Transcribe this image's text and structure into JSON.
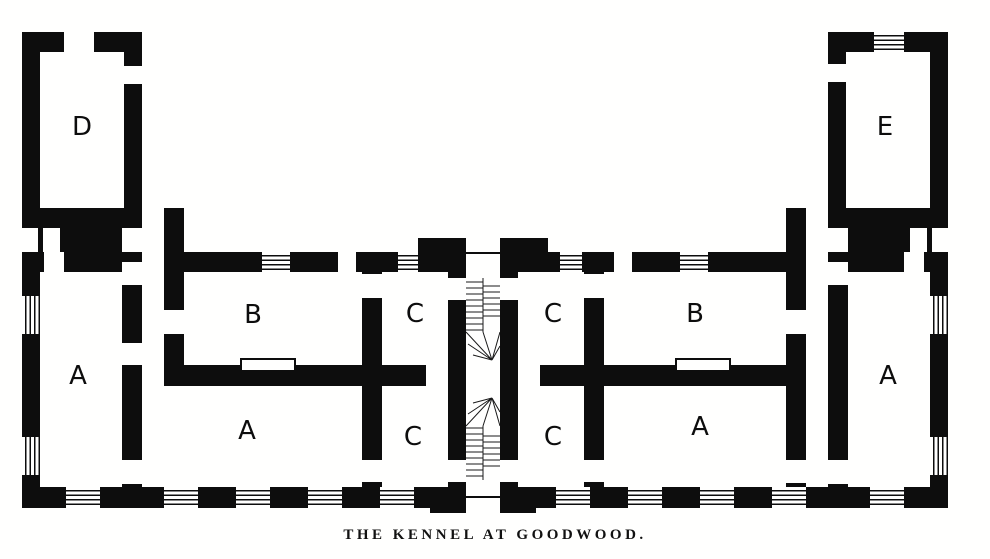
{
  "figure": {
    "type": "architectural-floor-plan-engraving",
    "caption": "THE KENNEL AT GOODWOOD.",
    "rooms": [
      {
        "key": "room-d",
        "label": "D"
      },
      {
        "key": "room-e",
        "label": "E"
      },
      {
        "key": "room-a-west-end",
        "label": "A"
      },
      {
        "key": "room-b-west",
        "label": "B"
      },
      {
        "key": "room-c-upper-west",
        "label": "C"
      },
      {
        "key": "room-c-upper-east",
        "label": "C"
      },
      {
        "key": "room-b-east",
        "label": "B"
      },
      {
        "key": "room-a-east-end",
        "label": "A"
      },
      {
        "key": "room-a-lower-west",
        "label": "A"
      },
      {
        "key": "room-c-lower-west",
        "label": "C"
      },
      {
        "key": "room-c-lower-east",
        "label": "C"
      },
      {
        "key": "room-a-lower-east",
        "label": "A"
      }
    ],
    "colors": {
      "ink": "#0d0d0d",
      "paper": "#fffffe"
    }
  }
}
